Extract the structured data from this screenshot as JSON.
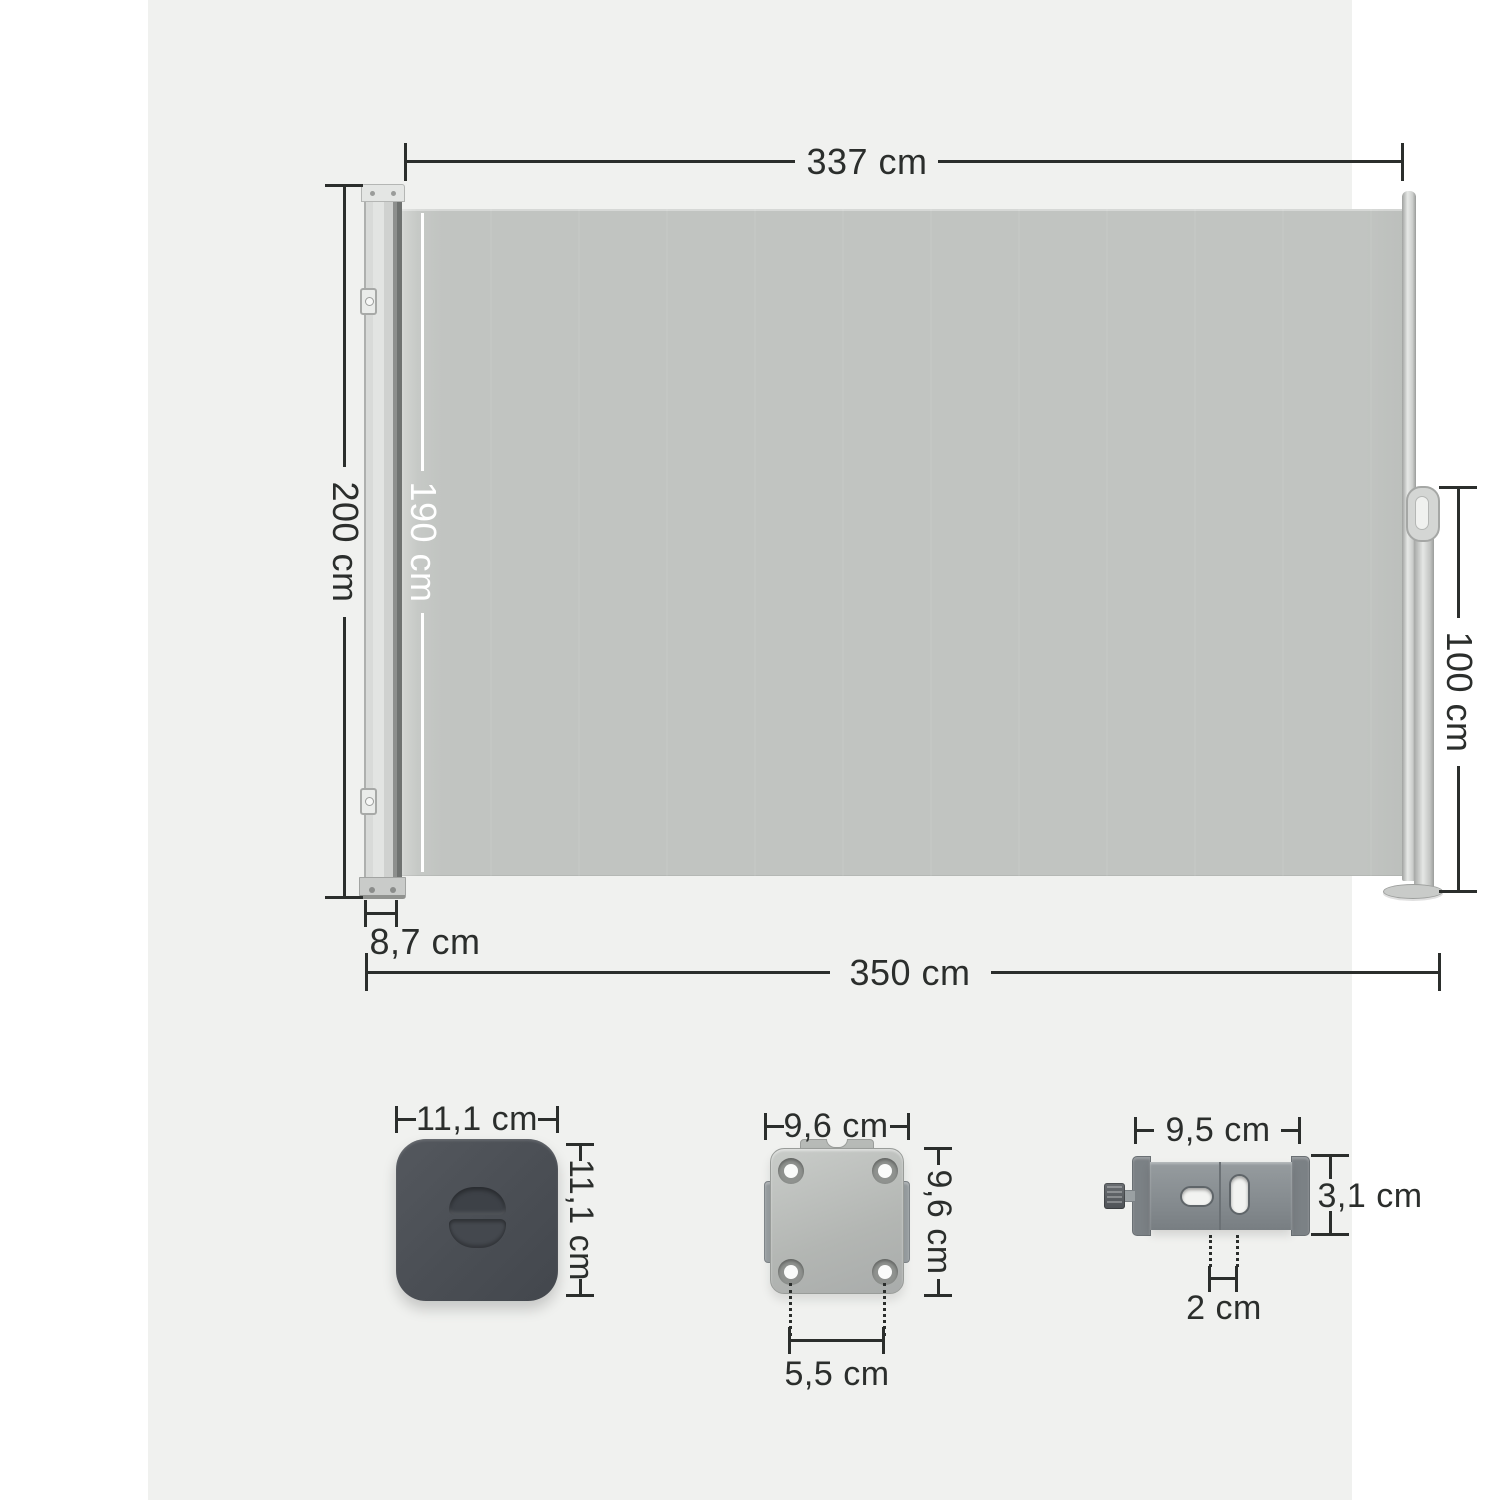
{
  "title": "Side awning dimension diagram",
  "unit_labels": {
    "fabric_width": "337 cm",
    "overall_height": "200 cm",
    "fabric_height": "190 cm",
    "pole_height": "100 cm",
    "cassette_depth": "8,7 cm",
    "overall_width": "350 cm",
    "cap_width": "11,1 cm",
    "cap_height": "11,1 cm",
    "plate_width": "9,6 cm",
    "plate_height": "9,6 cm",
    "plate_hole_spacing": "5,5 cm",
    "bracket_width": "9,5 cm",
    "bracket_height": "3,1 cm",
    "bracket_slot_spacing": "2 cm"
  },
  "colors": {
    "canvas": "#f0f1ef",
    "margin": "#ffffff",
    "fabric": "#c1c4c1",
    "dimension_line": "#2b2e2c",
    "fabric_dimension_line": "#ffffff",
    "cap_dark": "#4a4e54",
    "bracket_gray": "#868c90",
    "plate_gray": "#b4b7b4"
  }
}
